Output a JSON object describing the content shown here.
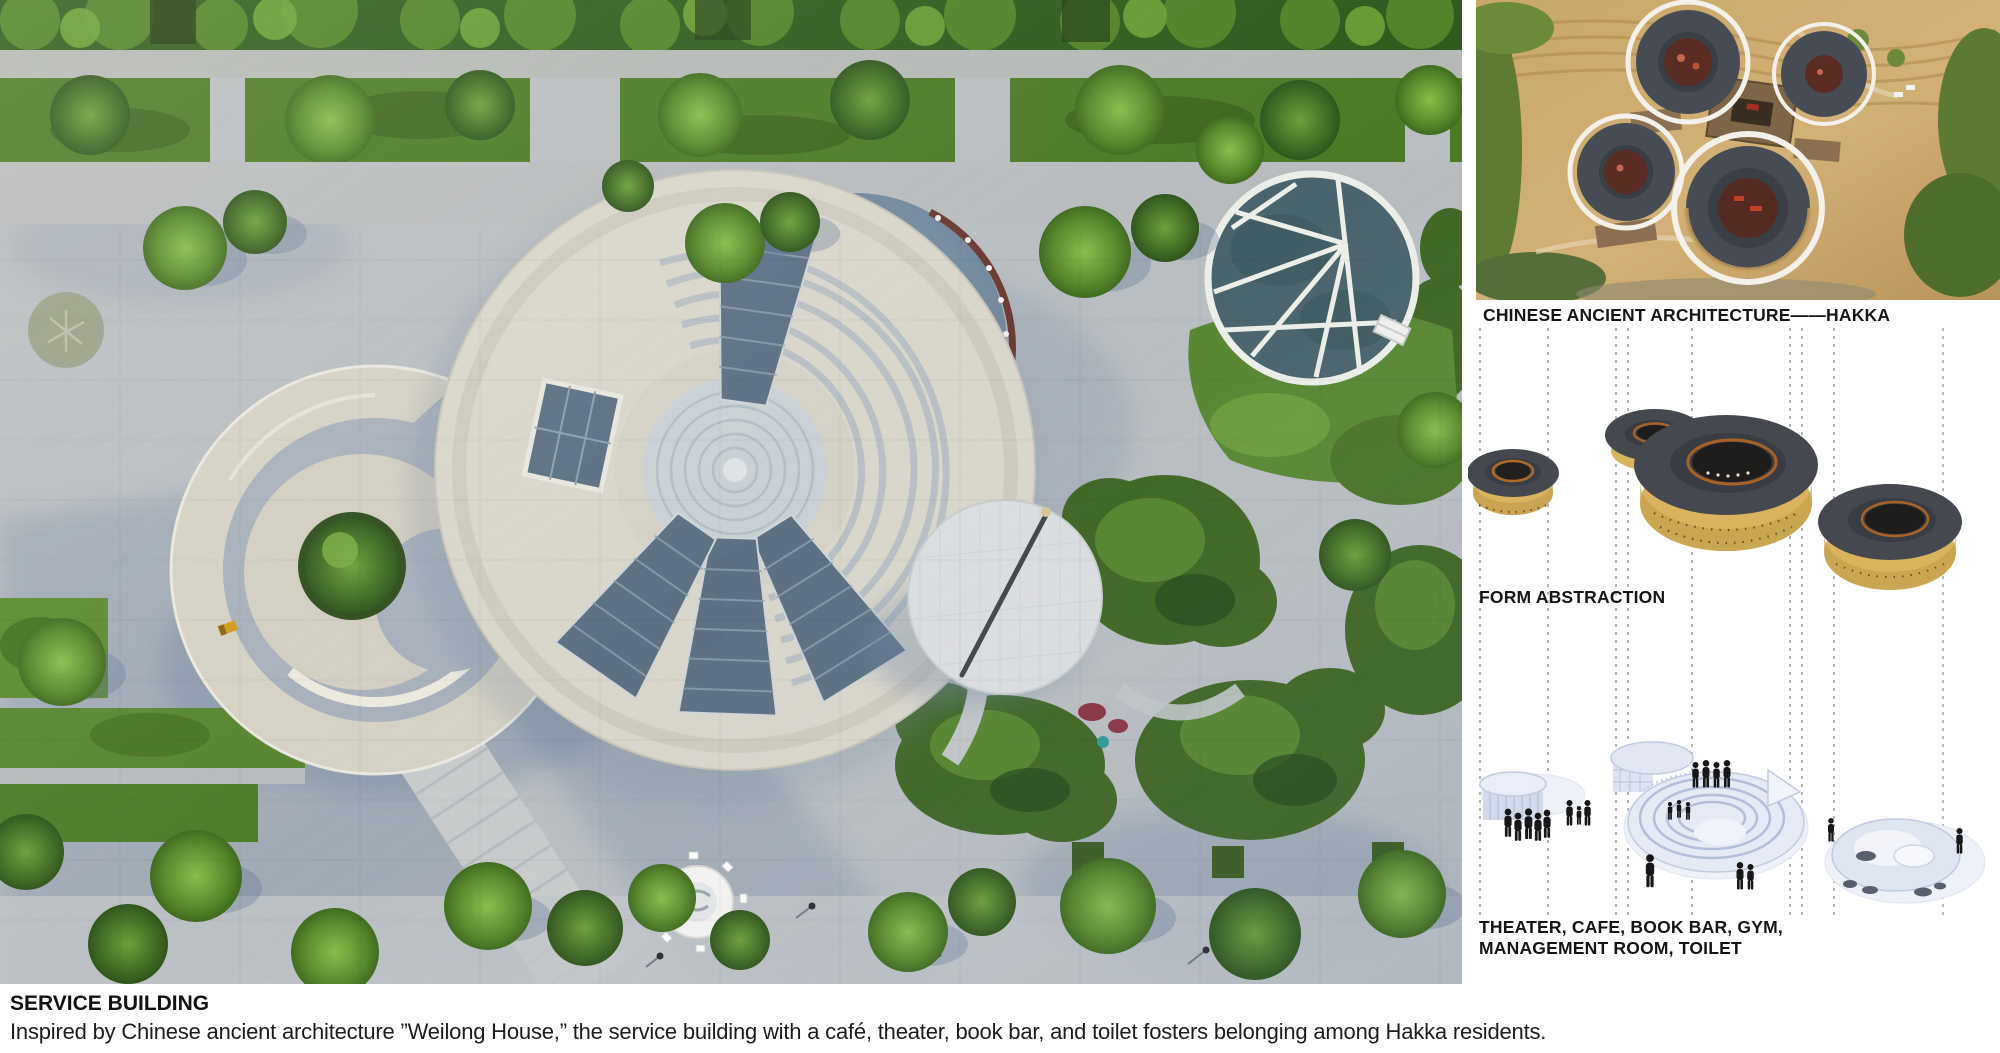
{
  "right_panel": {
    "hakka_caption": "CHINESE ANCIENT ARCHITECTURE——HAKKA",
    "form_caption": "FORM ABSTRACTION",
    "program_caption_line1": "THEATER, CAFE, BOOK BAR, GYM,",
    "program_caption_line2": "MANAGEMENT ROOM, TOILET"
  },
  "footer": {
    "title": "SERVICE BUILDING",
    "description": "Inspired by Chinese ancient architecture ”Weilong House,” the service building with a café, theater, book bar, and toilet fosters belonging among Hakka residents."
  },
  "palette": {
    "board_bg": "#ffffff",
    "caption_text": "#151515",
    "pavement_gray": "#b9bec2",
    "shadow_blue": "#72869f",
    "grass_green": "#55802a",
    "tree_green": "#4f7d28",
    "pool_blue": "#7d93a8",
    "building_cream": "#d9d6cb",
    "glass_teal": "#4a646d",
    "tulou_wall_tan": "#d9b35e",
    "tulou_roof_gray": "#45494f",
    "model_blue_white": "#e6eaf5",
    "silhouette_black": "#17171a",
    "dashed_line_gray": "#909090"
  }
}
